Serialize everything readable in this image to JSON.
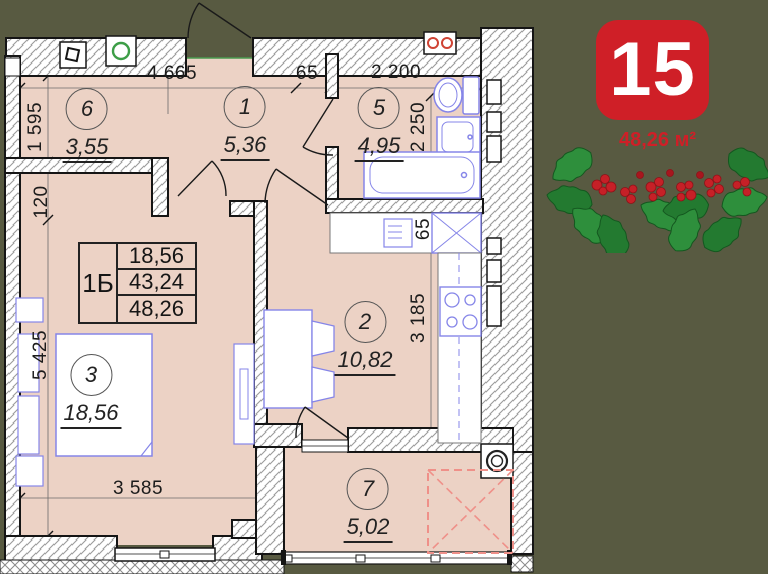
{
  "badge": {
    "number": "15",
    "area": "48,26 м²"
  },
  "plan": {
    "rooms": [
      {
        "number": "6",
        "area": "3,55"
      },
      {
        "number": "1",
        "area": "5,36"
      },
      {
        "number": "5",
        "area": "4,95"
      },
      {
        "number": "2",
        "area": "10,82"
      },
      {
        "number": "3",
        "area": "18,56"
      },
      {
        "number": "7",
        "area": "5,02"
      }
    ],
    "info_table": {
      "type": "1Б",
      "row1": "18,56",
      "row2": "43,24",
      "row3": "48,26"
    },
    "dimensions": {
      "top_left": "4 665",
      "top_mid": "65",
      "top_right": "2 200",
      "left_upper": "1 595",
      "left_small": "120",
      "left_lower": "5 425",
      "bath_vertical": "2 250",
      "kitchen_small": "65",
      "kitchen_vertical": "3 185",
      "bottom": "3 585"
    }
  },
  "colors": {
    "background_olive": "#585a41",
    "floor_pink": "#ecd2c5",
    "badge_red": "#cf1f27",
    "fixture_blue": "#8585e8",
    "holly_green": "#2e8f3c",
    "dashed_zone_red": "#ef9089"
  }
}
